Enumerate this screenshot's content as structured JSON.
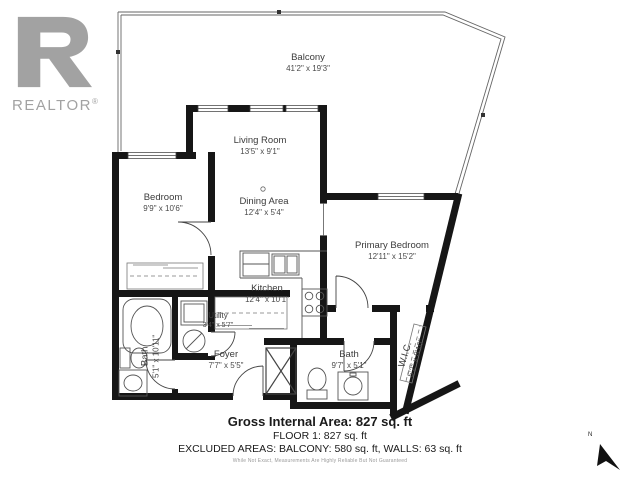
{
  "logo": {
    "brand": "REALTOR",
    "reg": "®"
  },
  "rooms": {
    "balcony": {
      "name": "Balcony",
      "dims": "41'2\" x 19'3\""
    },
    "living": {
      "name": "Living Room",
      "dims": "13'5\" x 9'1\""
    },
    "bedroom": {
      "name": "Bedroom",
      "dims": "9'9\" x 10'6\""
    },
    "dining": {
      "name": "Dining Area",
      "dims": "12'4\" x 5'4\""
    },
    "primary": {
      "name": "Primary Bedroom",
      "dims": "12'11\" x 15'2\""
    },
    "kitchen": {
      "name": "Kitchen",
      "dims": "12'4\" x 10'1\""
    },
    "utility": {
      "name": "Utility",
      "dims": "3'4\" x 5'7\""
    },
    "bath1": {
      "name": "Bath",
      "dims": "5'1\" x 10'11\""
    },
    "foyer": {
      "name": "Foyer",
      "dims": "7'7\" x 5'5\""
    },
    "bath2": {
      "name": "Bath",
      "dims": "9'7\" x 5'1\""
    },
    "wic": {
      "name": "W.I.C.",
      "dims": "5'2\" x 8'10\""
    }
  },
  "summary": {
    "gross": "Gross Internal Area: 827 sq. ft",
    "floor": "FLOOR 1: 827 sq. ft",
    "excluded": "EXCLUDED AREAS: BALCONY: 580 sq. ft, WALLS: 63 sq. ft",
    "disclaimer": "While Not Exact, Measurements Are Highly Reliable But Not Guaranteed"
  },
  "compass": {
    "label": "N"
  }
}
